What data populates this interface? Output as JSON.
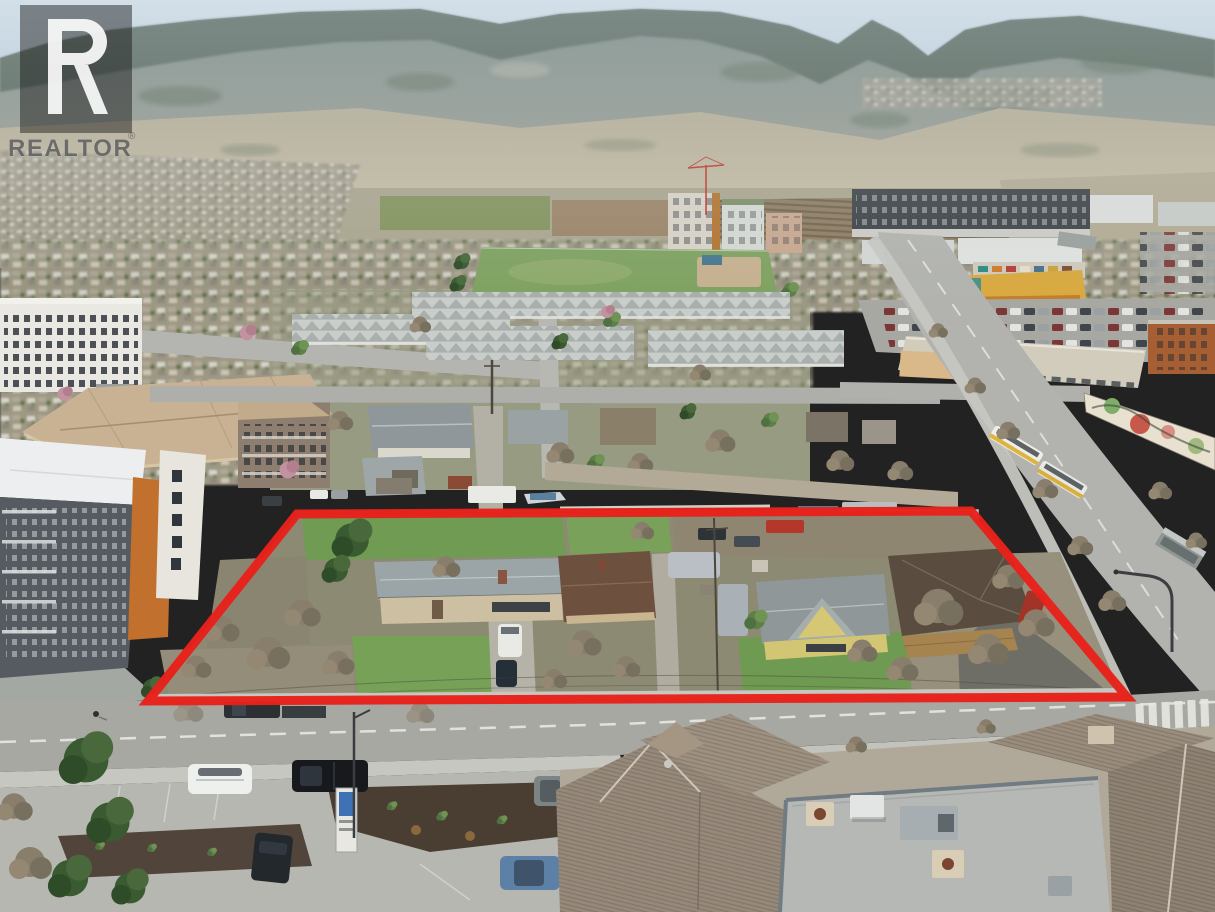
{
  "watermark": {
    "label": "REALTOR",
    "registered": "®",
    "logo_icon": "realtor-r-logo",
    "text_color": "#5e5e5e",
    "box_color": "#141414"
  },
  "scene": {
    "description": "Aerial drone photograph of an urban neighbourhood in a mountain valley; a red boundary outline marks a land-assembly property of several detached-house lots fronting a main street, with apartment buildings to the left, a park and commercial district behind, and a large building roof in the foreground.",
    "annotation_color": "#e8211b"
  },
  "palette": {
    "sky": "#cfdfe9",
    "mountain_forest": "#4d5c50",
    "hillside_tan": "#bbb197",
    "park_green": "#7fa261",
    "lawn_green": "#6f9b52",
    "road_asphalt": "#a8a8a2",
    "concrete": "#c6c7c1",
    "roof_brown": "#96897a",
    "accent_orange": "#c2702d",
    "yellow_retail": "#d9a940"
  }
}
